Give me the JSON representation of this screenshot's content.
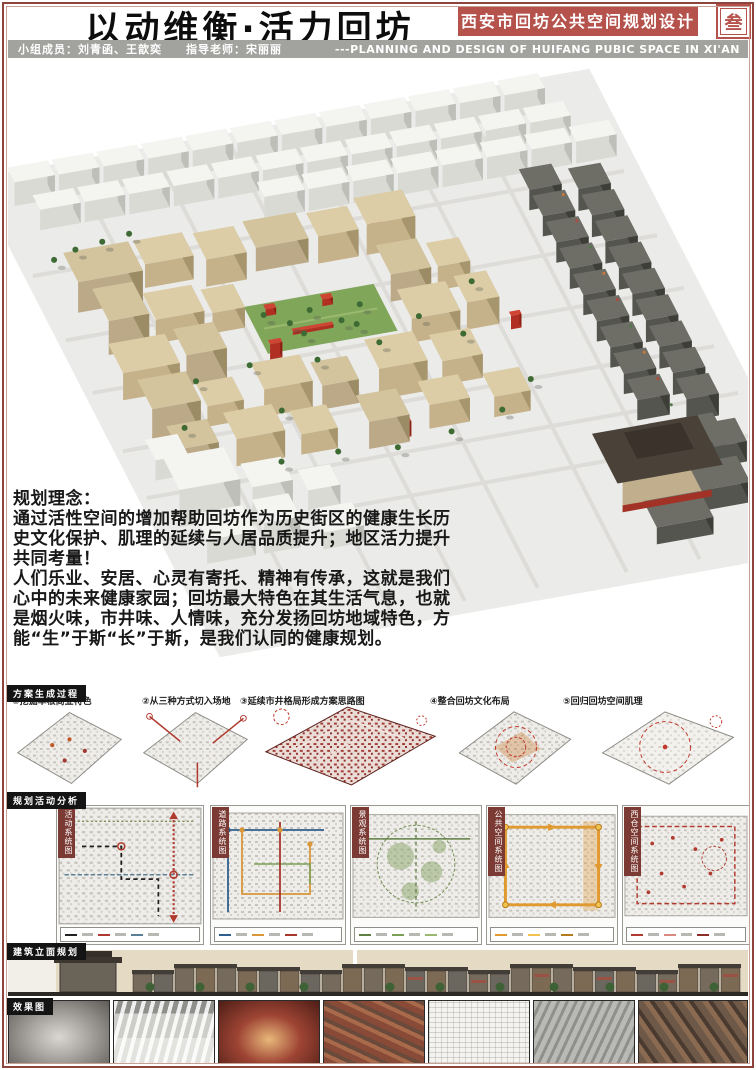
{
  "header": {
    "title": "以动维衡·活力回坊",
    "team_line": "小组成员：刘青函、王歆奕　　指导老师：宋丽丽",
    "banner": "西安市回坊公共空间规划设计",
    "corner_mark": "叁",
    "subtitle_en": "---PLANNING AND DESIGN OF HUIFANG PUBIC SPACE IN XI'AN"
  },
  "concept": {
    "heading": "规划理念：",
    "para1": "通过活性空间的增加帮助回坊作为历史街区的健康生长历史文化保护、肌理的延续与人居品质提升；地区活力提升共同考量！",
    "para2": "人们乐业、安居、心灵有寄托、精神有传承，这就是我们心中的未来健康家园；回坊最大特色在其生活气息，也就是烟火味，市井味、人情味，充分发扬回坊地域特色，方能“生”于斯“长”于斯，是我们认同的健康规划。"
  },
  "process": {
    "header": "方案生成过程",
    "steps": [
      "①挖掘草根商业特色",
      "②从三种方式切入场地",
      "③延续市井格局形成方案思路图",
      "④整合回坊文化布局",
      "⑤回归回坊空间肌理"
    ]
  },
  "analysis": {
    "header": "规划活动分析",
    "plans": [
      "活动系统图",
      "道路系统图",
      "景观系统图",
      "公共空间系统图",
      "西仓空间系统图"
    ]
  },
  "elevation": {
    "header": "建筑立面规划"
  },
  "renders": {
    "header": "效果图"
  },
  "colors": {
    "accent": "#b5524b",
    "frame": "#8d443c",
    "bar_gray": "#a2a29f",
    "header_box": "#141414"
  }
}
